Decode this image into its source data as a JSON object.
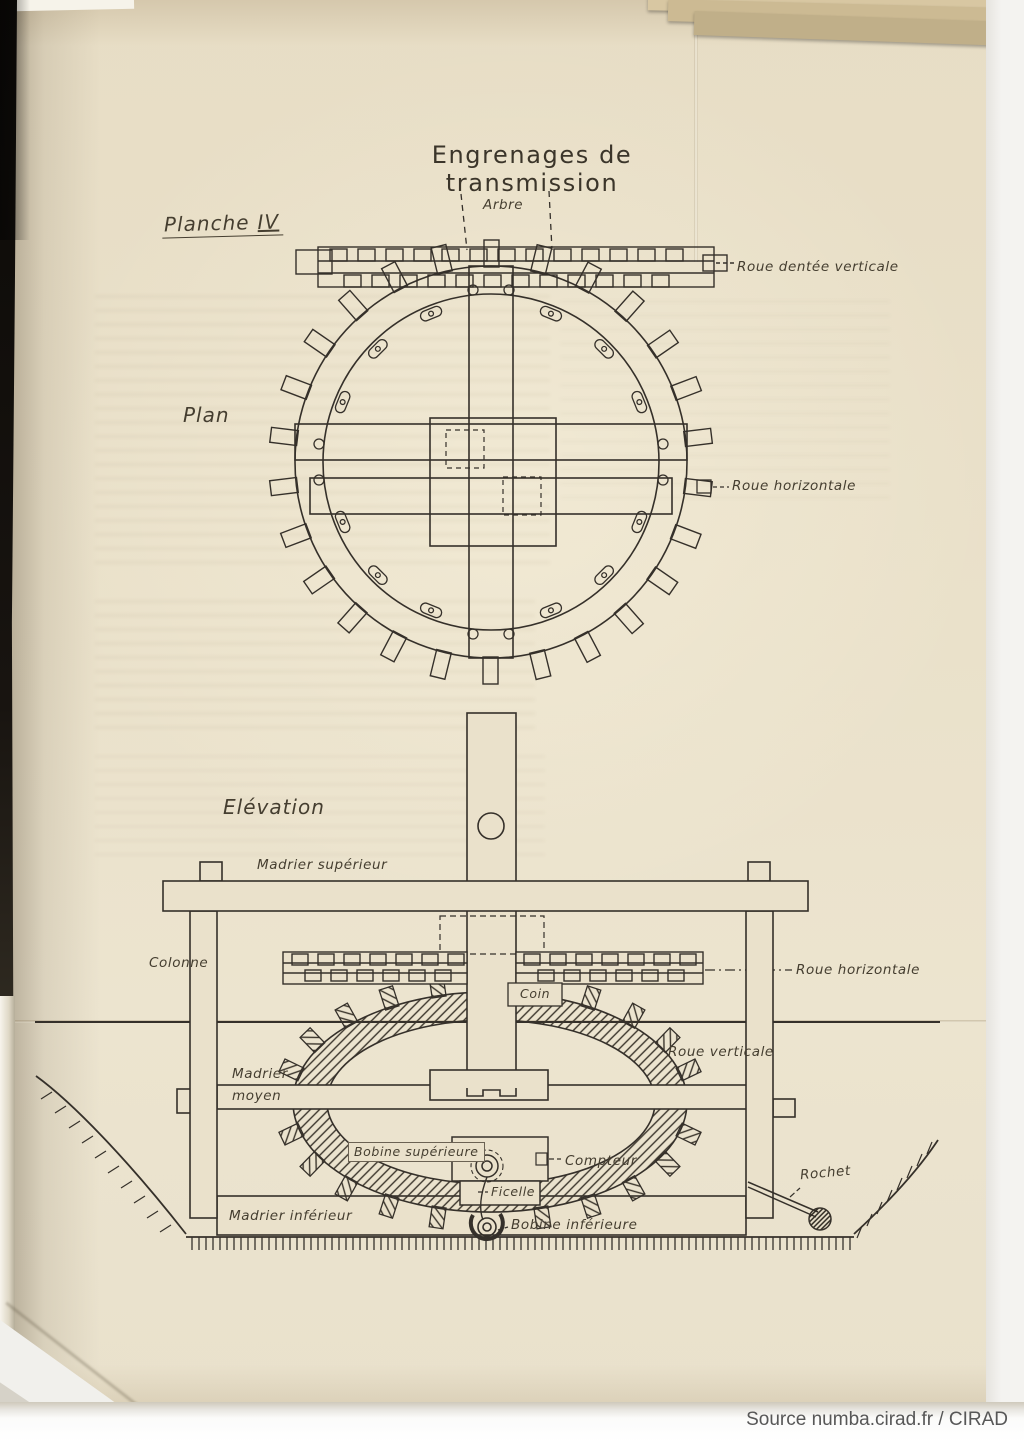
{
  "page": {
    "title": "Engrenages de transmission",
    "plate_label": "Planche",
    "plate_numeral": "IV",
    "view_plan_label": "Plan",
    "view_elevation_label": "Elévation"
  },
  "plan_labels": {
    "arbre": "Arbre",
    "roue_dentee_verticale": "Roue dentée verticale",
    "roue_horizontale": "Roue horizontale"
  },
  "elevation_labels": {
    "madrier_superieur": "Madrier supérieur",
    "colonne": "Colonne",
    "roue_horizontale": "Roue horizontale",
    "coin": "Coin",
    "roue_verticale": "Roue verticale",
    "madrier_moyen_line1": "Madrier",
    "madrier_moyen_line2": "moyen",
    "bobine_superieure": "Bobine supérieure",
    "compteur": "Compteur",
    "ficelle": "Ficelle",
    "rochet": "Rochet",
    "madrier_inferieur": "Madrier inférieur",
    "bobine_inferieure": "Bobine inférieure"
  },
  "attribution": {
    "text": "Source numba.cirad.fr / CIRAD"
  },
  "colors": {
    "paper": "#eae1cb",
    "ink": "#35302a",
    "attribution_text": "#575757"
  }
}
